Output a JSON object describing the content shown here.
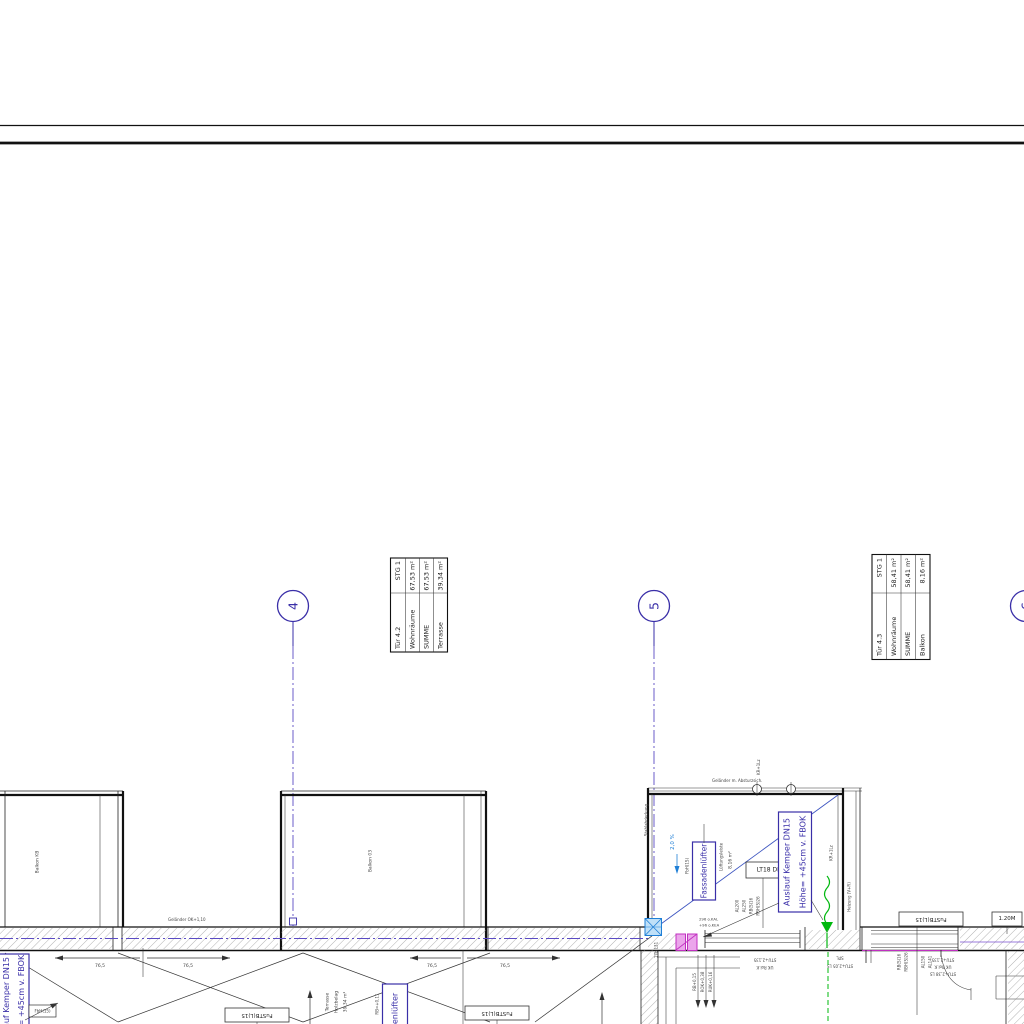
{
  "colors": {
    "ink": "#222222",
    "indigo": "#3a2fa8",
    "blue": "#1f7fd6",
    "green": "#00b80e",
    "magenta": "#c030c0"
  },
  "grid": {
    "b4": "4",
    "b5": "5",
    "b6": "6"
  },
  "tableA": {
    "rows": [
      [
        "Tür 4.2",
        "STG 1"
      ],
      [
        "Wohnräume",
        "67,53 m²"
      ],
      [
        "SUMME",
        "67,53 m²"
      ],
      [
        "Terrasse",
        "39,34 m²"
      ]
    ]
  },
  "tableB": {
    "rows": [
      [
        "Tür 4.3",
        "STG 1"
      ],
      [
        "Wohnräume",
        "58,41 m²"
      ],
      [
        "SUMME",
        "58,41 m²"
      ],
      [
        "Balkon",
        "8,16 m²"
      ]
    ]
  },
  "labels": {
    "balkon_left": "Balkon KB",
    "balkon_mid": "Balkon 03",
    "gelaender": "Geländer OK+1,10",
    "gelaender2": "Geländer m. Absturzsich.",
    "stahl": "Stahlabdeckung",
    "kr": "KR+1Lz",
    "slope": "2,0 %",
    "fbh": "FbH(1S)",
    "fassadenluefter": "Fassadenlüfter",
    "lueftung": "Lüftungsleiste",
    "area": "8,16 m²",
    "lt": "LT18 DB",
    "auslauf1": "Auslauf Kemper DN15",
    "auslauf2": "Höhe= +45cm v. FBOK",
    "heizung": "Heizung (V+R)",
    "l17": "17b L31",
    "okal": "296 o.KAL",
    "okea": "+96 o.KEA",
    "terrasse": "Terrasse",
    "holzbelag": "Holzbelag",
    "terr_area": "39,34 m²",
    "rb011": "RB=+0,11",
    "fbh15": "FbH(15)",
    "fustb": "FuSTB(L)15",
    "tag120": "1.20M",
    "rbs16": "RB(S)16",
    "rbhs26": "RBH(S)26",
    "al200": "AL200",
    "al250": "AL250",
    "al150": "AL150",
    "al141": "AL141",
    "rb015": "RB+0,15",
    "rok038": "ROK+0,38",
    "ruk016": "RUK+0,16",
    "stu1": "STU+2,135",
    "stu2": "UK Rol.K",
    "stu3": "STU+2,38 LS",
    "spl": "SPL",
    "stu4": "STU+2,05 LS"
  },
  "dims": {
    "d1": "76,5",
    "d2": "76,5",
    "d3": "76,5",
    "d4": "76,5"
  }
}
